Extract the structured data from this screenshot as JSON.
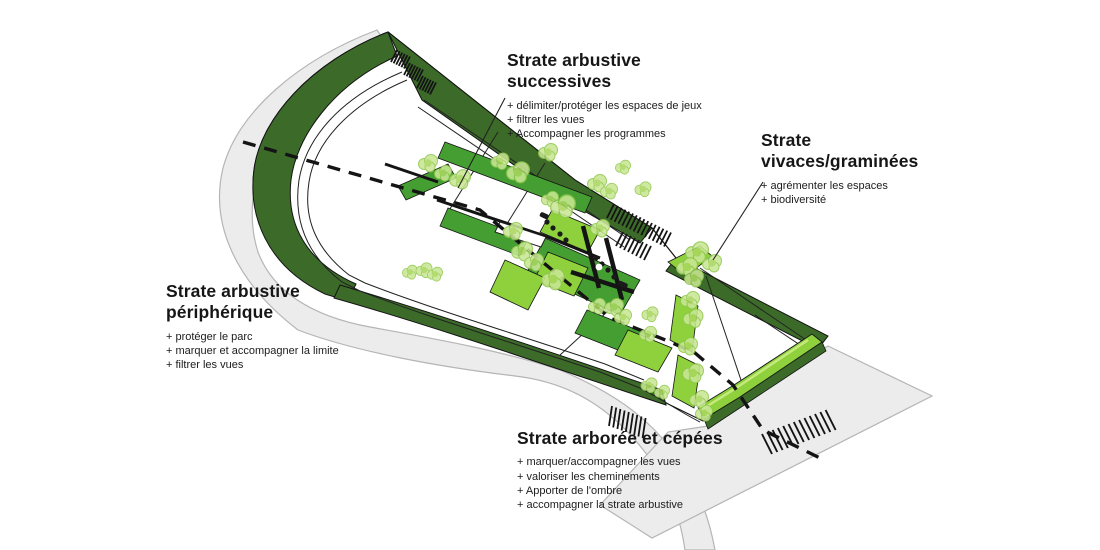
{
  "diagram": {
    "type": "landscape-strategy-axonometric-plan",
    "annotations": [
      {
        "id": "arbustive-successives",
        "title_lines": [
          "Strate arbustive",
          "successives"
        ],
        "bullets": [
          "+ délimiter/protéger les espaces de jeux",
          "+ filtrer les vues",
          "+ Accompagner les programmes"
        ]
      },
      {
        "id": "vivaces-graminees",
        "title_lines": [
          "Strate",
          "vivaces/graminées"
        ],
        "bullets": [
          "+ agrémenter les espaces",
          "+ biodiversité"
        ]
      },
      {
        "id": "arbustive-peripherique",
        "title_lines": [
          "Strate arbustive",
          "périphérique"
        ],
        "bullets": [
          "+ protéger le parc",
          "+ marquer et accompagner la limite",
          "+ filtrer les vues"
        ]
      },
      {
        "id": "arboree-cepees",
        "title_lines": [
          "Strate arborée et cépées"
        ],
        "bullets": [
          "+ marquer/accompagner les vues",
          "+ valoriser les cheminements",
          "+ Apporter de l'ombre",
          "+ accompagner la strate arbustive"
        ]
      }
    ],
    "colors": {
      "road-gray": "#ececec",
      "road-border": "#b5b5b5",
      "dark-green": "#3c6b29",
      "medium-green": "#449e31",
      "bright-green": "#8ed13c",
      "pale-green": "#c6e97e",
      "tree-fill": "#c9e795",
      "tree-core": "#a9d75f",
      "tree-stroke": "#8fc84d",
      "ink": "#141414"
    }
  }
}
